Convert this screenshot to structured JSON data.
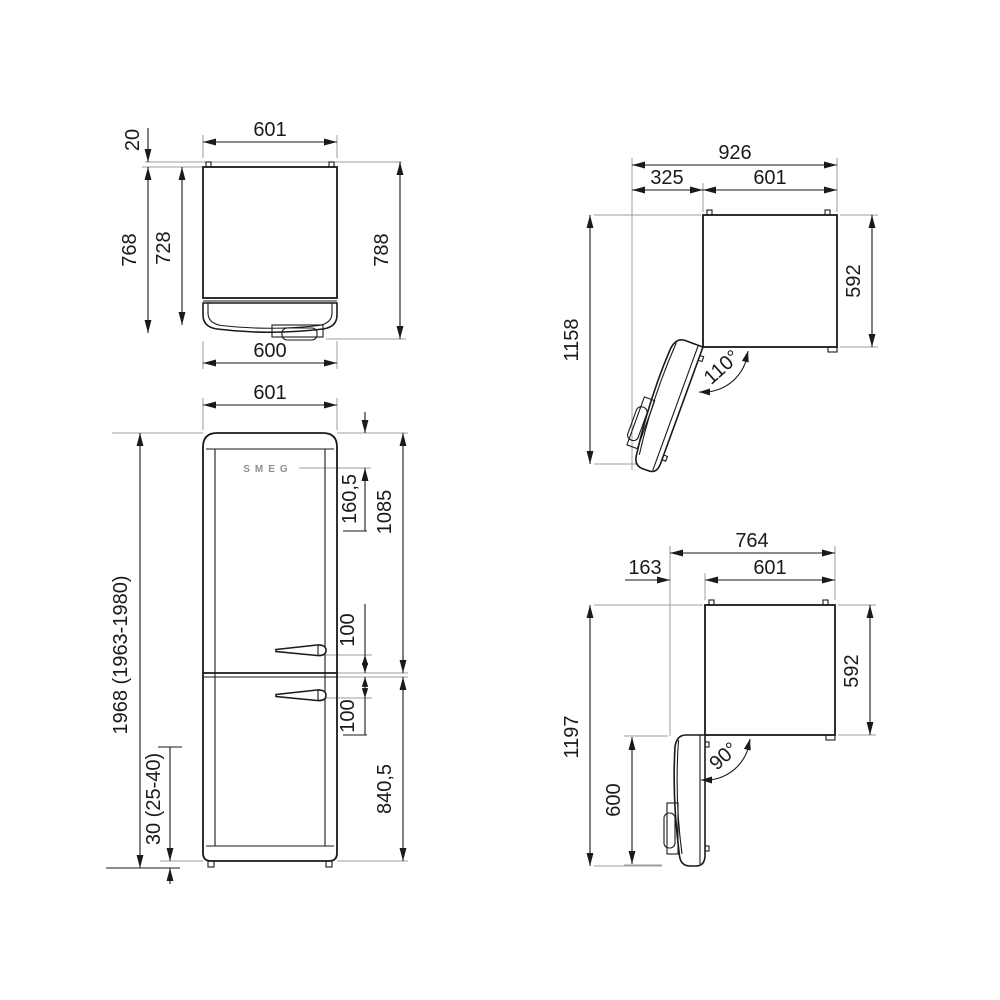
{
  "views": {
    "tl": {
      "name": "top view - door closed",
      "dims": {
        "width": "601",
        "rear_spacer": "20",
        "depth_total": "768",
        "depth_cabinet": "728",
        "depth_handle": "788",
        "door_width": "600"
      }
    },
    "fv": {
      "name": "front view",
      "logo": "SMEG",
      "dims": {
        "width": "601",
        "logo_top": "160,5",
        "upper": "1085",
        "handle_u": "100",
        "handle_l": "100",
        "lower": "840,5",
        "total": "1968 (1963-1980)",
        "plinth": "30 (25-40)"
      }
    },
    "tr": {
      "name": "top view - door open 110",
      "dims": {
        "total": "926",
        "swing": "325",
        "width": "601",
        "depth_open": "1158",
        "depth": "592",
        "angle": "110°"
      }
    },
    "br": {
      "name": "top view - door open 90",
      "dims": {
        "total": "764",
        "clearance": "163",
        "width": "601",
        "depth_open": "1197",
        "depth": "592",
        "door": "600",
        "angle": "90°"
      }
    }
  }
}
